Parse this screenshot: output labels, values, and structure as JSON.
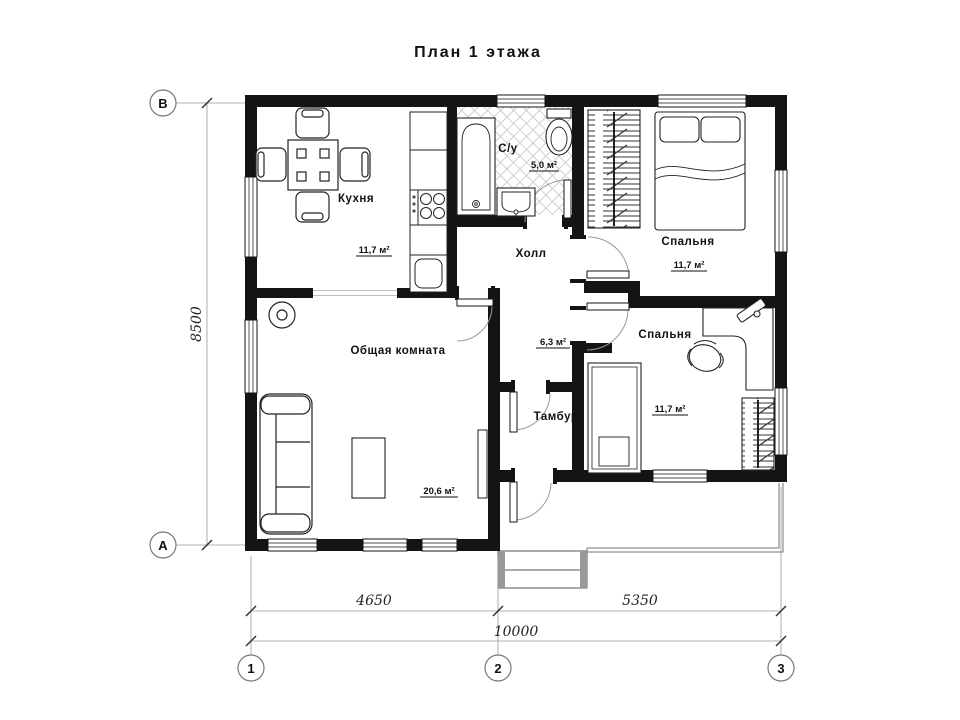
{
  "title": "План 1 этажа",
  "rooms": {
    "kitchen": {
      "name": "Кухня",
      "area": "11,7 м²"
    },
    "bathroom": {
      "name": "С/у",
      "area": "5,0 м²"
    },
    "bedroom_top": {
      "name": "Спальня",
      "area": "11,7 м²"
    },
    "hall": {
      "name": "Холл",
      "area": "6,3 м²"
    },
    "living": {
      "name": "Общая комната",
      "area": "20,6 м²"
    },
    "tambur": {
      "name": "Тамбур"
    },
    "bedroom_bottom": {
      "name": "Спальня",
      "area": "11,7 м²"
    }
  },
  "dimensions": {
    "width_left": "4650",
    "width_right": "5350",
    "width_total": "10000",
    "height": "8500"
  },
  "axes": {
    "row_top": "В",
    "row_bottom": "А",
    "col_1": "1",
    "col_2": "2",
    "col_3": "3"
  },
  "colors": {
    "wall": "#141414",
    "thin_line": "#888888",
    "tile_line": "#c8c8c8"
  }
}
